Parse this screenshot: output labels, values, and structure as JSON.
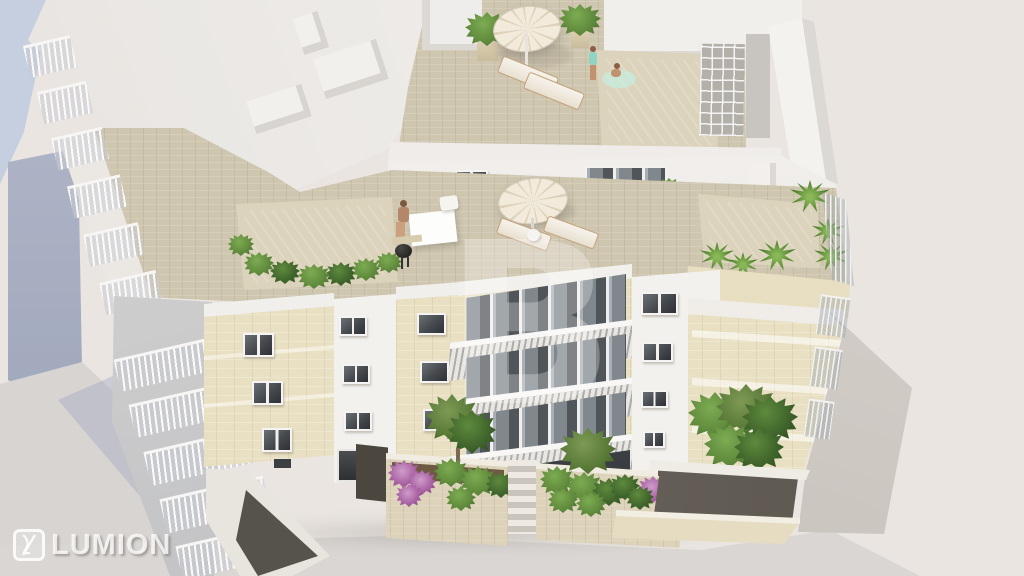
{
  "watermarks": {
    "center_letter": "B",
    "brand_text": "LUMION",
    "brand_icon": "lumion-logo-icon"
  },
  "colors": {
    "background": "#eae5e1",
    "sky_blue": "#c6cfe0",
    "neighbor_wall": "#a8afc2",
    "street": "#d8d4d1",
    "street_shadow": "#b9c0d4",
    "roof_white": "#f0eeeb",
    "wall_white": "#f3f1ee",
    "wall_shade": "#d9d5d1",
    "stone_pavement": "#cfc6b0",
    "stone_rim": "#dcd3bc",
    "facade_beige": "#e9e0c3",
    "facade_beige_shade": "#ddd2b4",
    "pool_water": "#8bd7c6",
    "pool_water_deep": "#73cab7",
    "pool_water_light": "#abe5d8",
    "window_glass": "#45494d",
    "glass_grey": "#9ba2a8",
    "plant_green": "#5f8a3c",
    "plant_dark": "#3f642b",
    "flower_purple": "#a75fa2",
    "umbrella": "#ece3d0",
    "wood": "#c4a37c",
    "skin": "#c29170",
    "soil": "#6e5a42",
    "watermark_white": "rgba(255,255,255,0.78)"
  }
}
